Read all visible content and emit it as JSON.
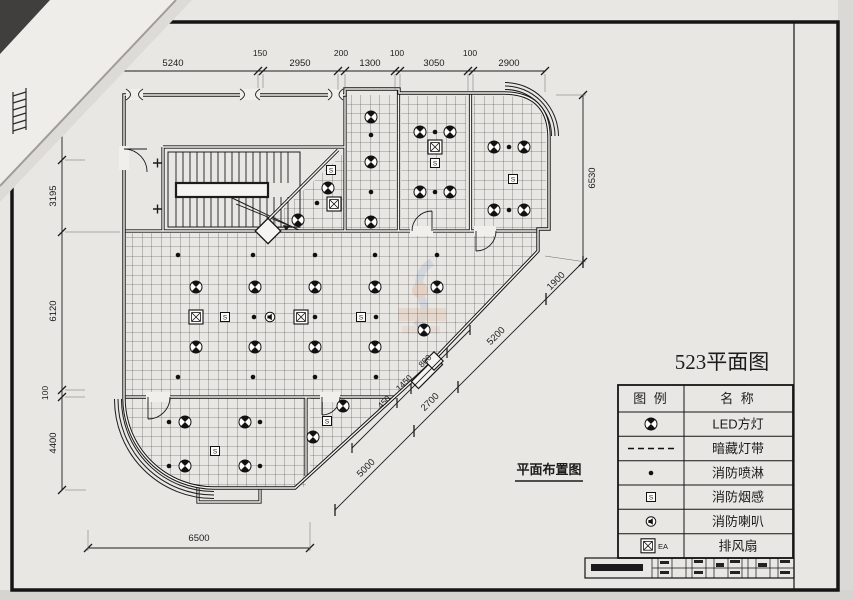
{
  "page": {
    "title": "523平面图",
    "plan_label": "平面布置图"
  },
  "legend": {
    "header": {
      "symbol_col": "图 例",
      "name_col": "名 称"
    },
    "rows": [
      {
        "symbol": "led-square-light-icon",
        "name": "LED方灯"
      },
      {
        "symbol": "concealed-light-strip-icon",
        "name": "暗藏灯带"
      },
      {
        "symbol": "fire-sprinkler-icon",
        "name": "消防喷淋"
      },
      {
        "symbol": "smoke-detector-icon",
        "name": "消防烟感"
      },
      {
        "symbol": "fire-horn-icon",
        "name": "消防喇叭"
      },
      {
        "symbol": "exhaust-fan-icon",
        "name": "排风扇",
        "tag": "EA"
      }
    ]
  },
  "dimensions": {
    "top": [
      "5240",
      "150",
      "2950",
      "200",
      "1300",
      "100",
      "3050",
      "100",
      "2900"
    ],
    "left": [
      "2400",
      "3195",
      "6120",
      "100",
      "4400"
    ],
    "right_vertical": "6530",
    "diagonal_outer": [
      "1900",
      "5200",
      "2700",
      "5000"
    ],
    "diagonal_inner": [
      "800",
      "1450",
      "450"
    ],
    "bottom": "6500"
  },
  "glyphs": {
    "smoke_letter": "S"
  }
}
